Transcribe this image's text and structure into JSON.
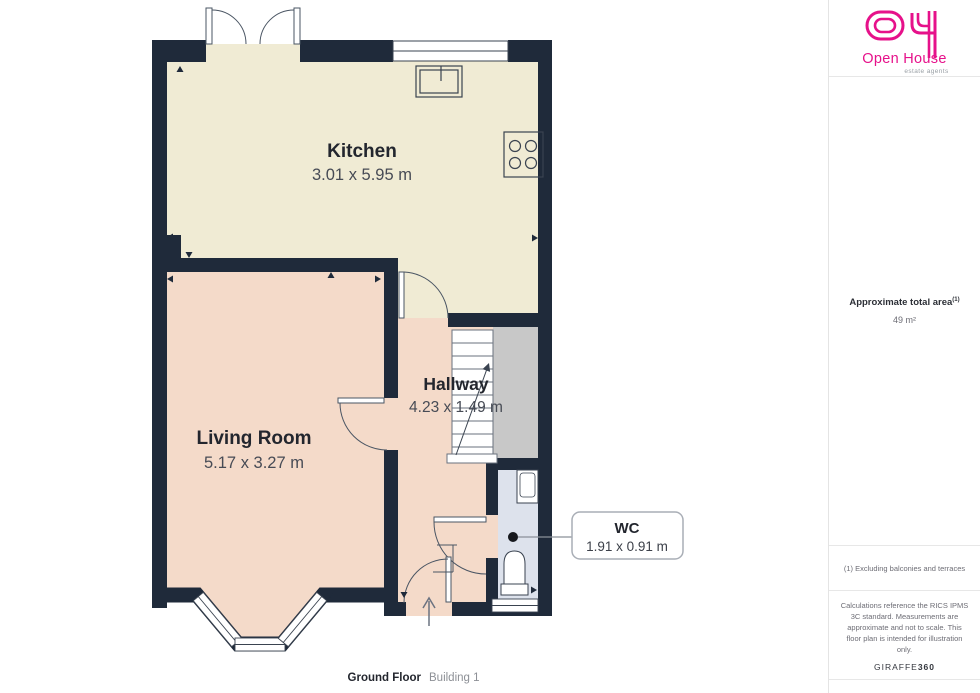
{
  "plan": {
    "rooms": [
      {
        "name": "Kitchen",
        "dims": "3.01 x 5.95 m"
      },
      {
        "name": "Living Room",
        "dims": "5.17 x 3.27 m"
      },
      {
        "name": "Hallway",
        "dims": "4.23 x 1.49 m"
      },
      {
        "name": "WC",
        "dims": "1.91 x 0.91 m"
      }
    ],
    "footer": {
      "floor": "Ground Floor",
      "building": "Building 1"
    },
    "colors": {
      "wall": "#1f2a3a",
      "kitchen_floor": "#f0ebd4",
      "living_floor": "#f4dac9",
      "hallway_floor": "#f4dac9",
      "landing": "#c8c8c8",
      "wc_floor": "#dde2ec"
    }
  },
  "sidebar": {
    "logo": {
      "brand": "Open House",
      "tagline": "estate agents",
      "color": "#e6118a"
    },
    "area": {
      "title": "Approximate total area",
      "superscript": "(1)",
      "value": "49 m²"
    },
    "footnote": "(1) Excluding balconies and terraces",
    "disclaimer": "Calculations reference the RICS IPMS 3C standard. Measurements are approximate and not to scale. This floor plan is intended for illustration only.",
    "credit": {
      "brand": "GIRAFFE",
      "suffix": "360"
    }
  }
}
